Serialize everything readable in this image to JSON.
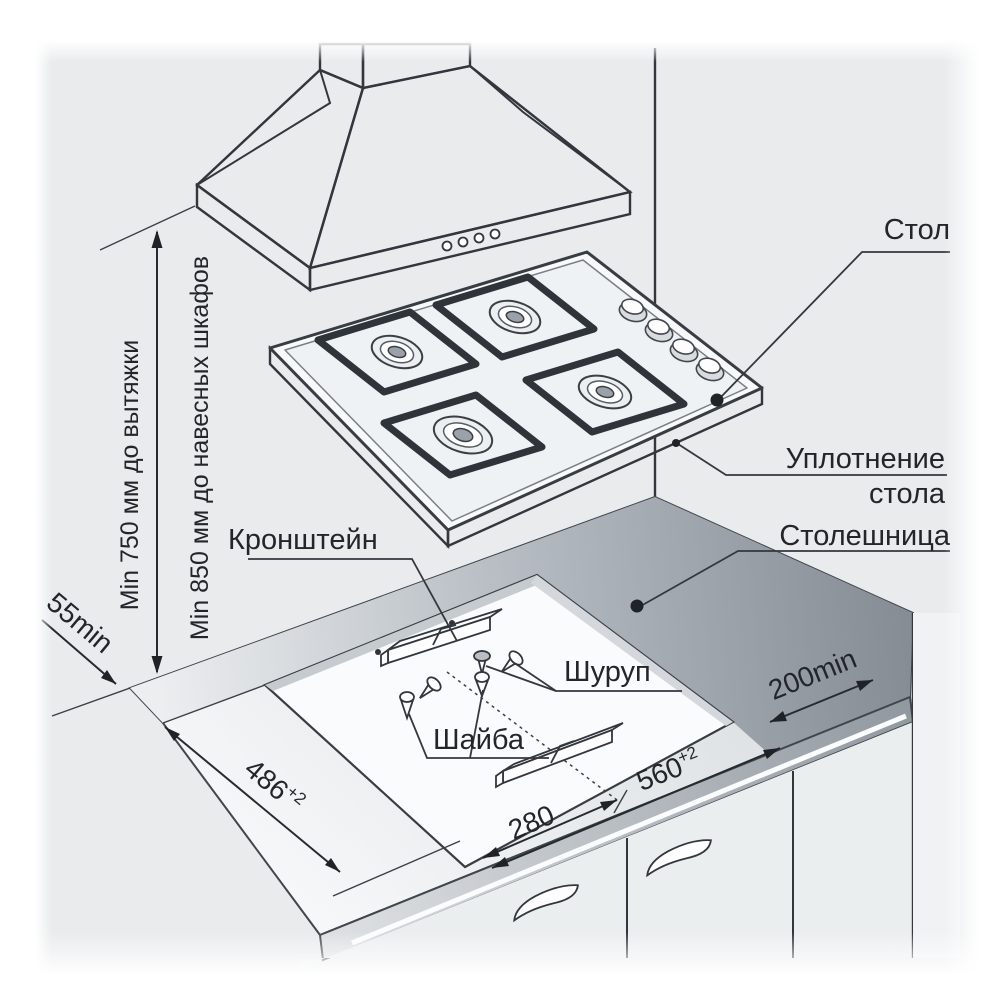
{
  "diagram": {
    "title": "Gas hob installation diagram",
    "labels": {
      "table": "Стол",
      "seal_line1": "Уплотнение",
      "seal_line2": "стола",
      "worktop": "Столешница",
      "bracket": "Кронштейн",
      "screw": "Шуруп",
      "washer": "Шайба"
    },
    "dims": {
      "hood": "Min 750 мм до вытяжки",
      "cabinets": "Min 850 мм до навесных шкафов",
      "back_gap": "55min",
      "depth": {
        "value": "486",
        "sup": "+2"
      },
      "center": "280",
      "width": {
        "value": "560",
        "sup": "+2"
      },
      "side_gap": "200min"
    },
    "colors": {
      "background": "#e9ebed",
      "line": "#32373d",
      "text": "#22262b",
      "counter_dark": "#8d949b",
      "cutout": "#fafbfc"
    }
  }
}
